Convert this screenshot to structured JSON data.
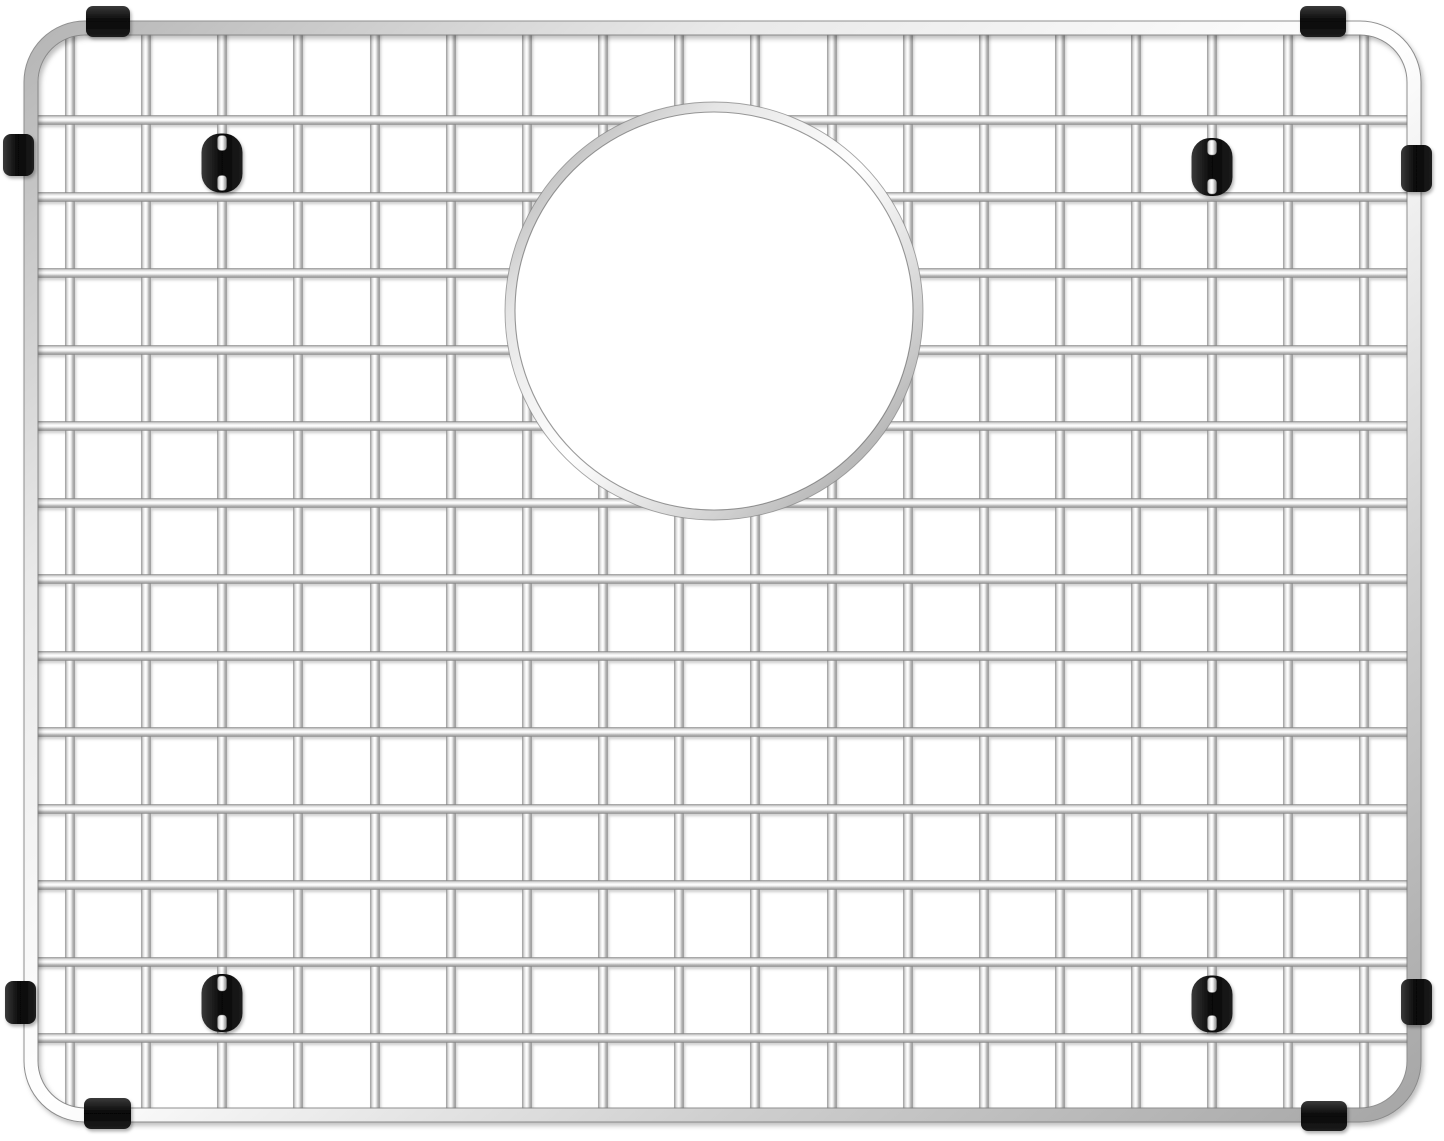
{
  "scene": {
    "description": "Product photograph of a rectangular stainless-steel sink bottom grid with a round drain opening, protective black rubber edge bumpers and black rubber feet, on a plain white background",
    "object": "stainless-steel-sink-grid",
    "background_color": "#ffffff"
  },
  "canvas": {
    "width": 1444,
    "height": 1141
  },
  "frame": {
    "x1": 31,
    "y1": 28,
    "x2": 1414,
    "y2": 1115,
    "corner_radius": 54,
    "tube_width": 13
  },
  "grid": {
    "wire_width": 9,
    "vertical_wire_x": [
      70,
      146,
      222,
      298,
      375,
      451,
      527,
      603,
      679,
      755,
      832,
      908,
      984,
      1060,
      1136,
      1212,
      1288,
      1364
    ],
    "horizontal_wire_y": [
      120,
      197,
      273,
      350,
      426,
      503,
      579,
      656,
      732,
      809,
      885,
      962,
      1038
    ]
  },
  "drain_opening": {
    "cx": 714,
    "cy": 311,
    "outer_radius": 209,
    "ring_width": 10
  },
  "bumpers": [
    {
      "id": "top-left",
      "edge": "top",
      "x": 86,
      "y": 6,
      "width": 44,
      "height": 31
    },
    {
      "id": "top-right",
      "edge": "top",
      "x": 1300,
      "y": 6,
      "width": 46,
      "height": 31
    },
    {
      "id": "left-upper",
      "edge": "left",
      "x": 3,
      "y": 134,
      "width": 31,
      "height": 42
    },
    {
      "id": "right-upper",
      "edge": "right",
      "x": 1401,
      "y": 145,
      "width": 31,
      "height": 47
    },
    {
      "id": "left-lower",
      "edge": "left",
      "x": 5,
      "y": 981,
      "width": 31,
      "height": 43
    },
    {
      "id": "right-lower",
      "edge": "right",
      "x": 1401,
      "y": 979,
      "width": 31,
      "height": 46
    },
    {
      "id": "bottom-left",
      "edge": "bottom",
      "x": 84,
      "y": 1098,
      "width": 47,
      "height": 31
    },
    {
      "id": "bottom-right",
      "edge": "bottom",
      "x": 1301,
      "y": 1101,
      "width": 46,
      "height": 30
    }
  ],
  "feet": [
    {
      "id": "top-left",
      "cx": 222,
      "cy": 163,
      "width": 41,
      "height": 59
    },
    {
      "id": "top-right",
      "cx": 1212,
      "cy": 167,
      "width": 41,
      "height": 58
    },
    {
      "id": "bottom-left",
      "cx": 222,
      "cy": 1003,
      "width": 41,
      "height": 58
    },
    {
      "id": "bottom-right",
      "cx": 1212,
      "cy": 1004,
      "width": 41,
      "height": 57
    }
  ],
  "colors": {
    "background": "#ffffff",
    "chrome_stops": [
      "#8f8f8f",
      "#d6d6d6",
      "#ffffff",
      "#f0f0f0",
      "#b3b3b3",
      "#9a9a9a"
    ],
    "chrome_offsets": [
      0,
      0.15,
      0.42,
      0.6,
      0.82,
      1
    ],
    "frame_stops": [
      "#b5b5b5",
      "#e9e9e9",
      "#ffffff",
      "#cfcfcf",
      "#a6a6a6"
    ],
    "ring_stops": [
      "#a0a0a0",
      "#e5e5e5",
      "#ffffff",
      "#d2d2d2",
      "#999999"
    ],
    "rubber_stops": [
      "#3a3a3a",
      "#060606",
      "#1d1d1d"
    ],
    "wire_edge": "#7d7d7d",
    "ring_inner_edge": "#565656",
    "shadow": "#000000"
  }
}
